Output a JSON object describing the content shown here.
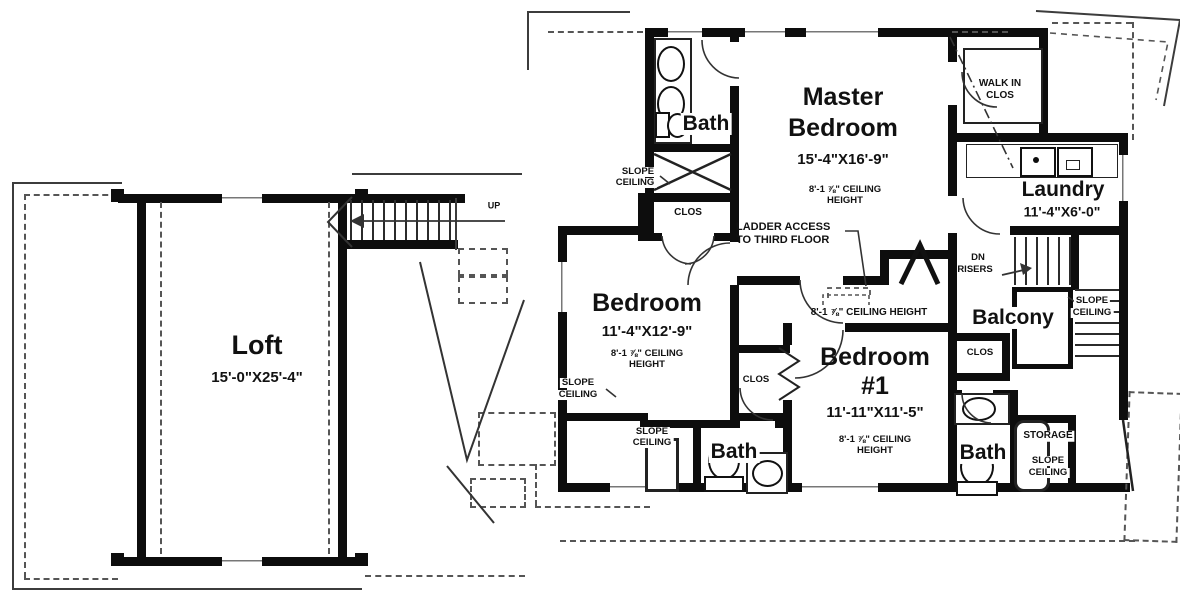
{
  "rooms": {
    "loft": {
      "name": "Loft",
      "dims": "15'-0\"X25'-4\""
    },
    "master": {
      "line1": "Master",
      "line2": "Bedroom",
      "dims": "15'-4\"X16'-9\"",
      "ceil1": "8'-1 ⅞\" CEILING",
      "ceil2": "HEIGHT"
    },
    "bath_top": {
      "name": "Bath"
    },
    "walkin": {
      "line1": "WALK IN",
      "line2": "CLOS"
    },
    "laundry": {
      "name": "Laundry",
      "dims": "11'-4\"X6'-0\""
    },
    "bedroom": {
      "name": "Bedroom",
      "dims": "11'-4\"X12'-9\"",
      "ceil1": "8'-1 ⅞\" CEILING",
      "ceil2": "HEIGHT"
    },
    "bedroom1": {
      "line1": "Bedroom",
      "line2": "#1",
      "dims": "11'-11\"X11'-5\"",
      "ceil1": "8'-1 ⅞\" CEILING",
      "ceil2": "HEIGHT"
    },
    "balcony": {
      "name": "Balcony"
    },
    "bath_bottom": {
      "name": "Bath"
    },
    "bath_right": {
      "name": "Bath"
    },
    "storage": {
      "name": "STORAGE"
    }
  },
  "annotations": {
    "hall_ceiling": "8'-1 ⅞\" CEILING HEIGHT",
    "ladder1": "LADDER ACCESS",
    "ladder2": "TO THIRD FLOOR",
    "up": "UP",
    "dn1": "DN",
    "dn2": "RISERS",
    "slope1": "SLOPE",
    "slope2": "CEILING",
    "clos": "CLOS"
  }
}
